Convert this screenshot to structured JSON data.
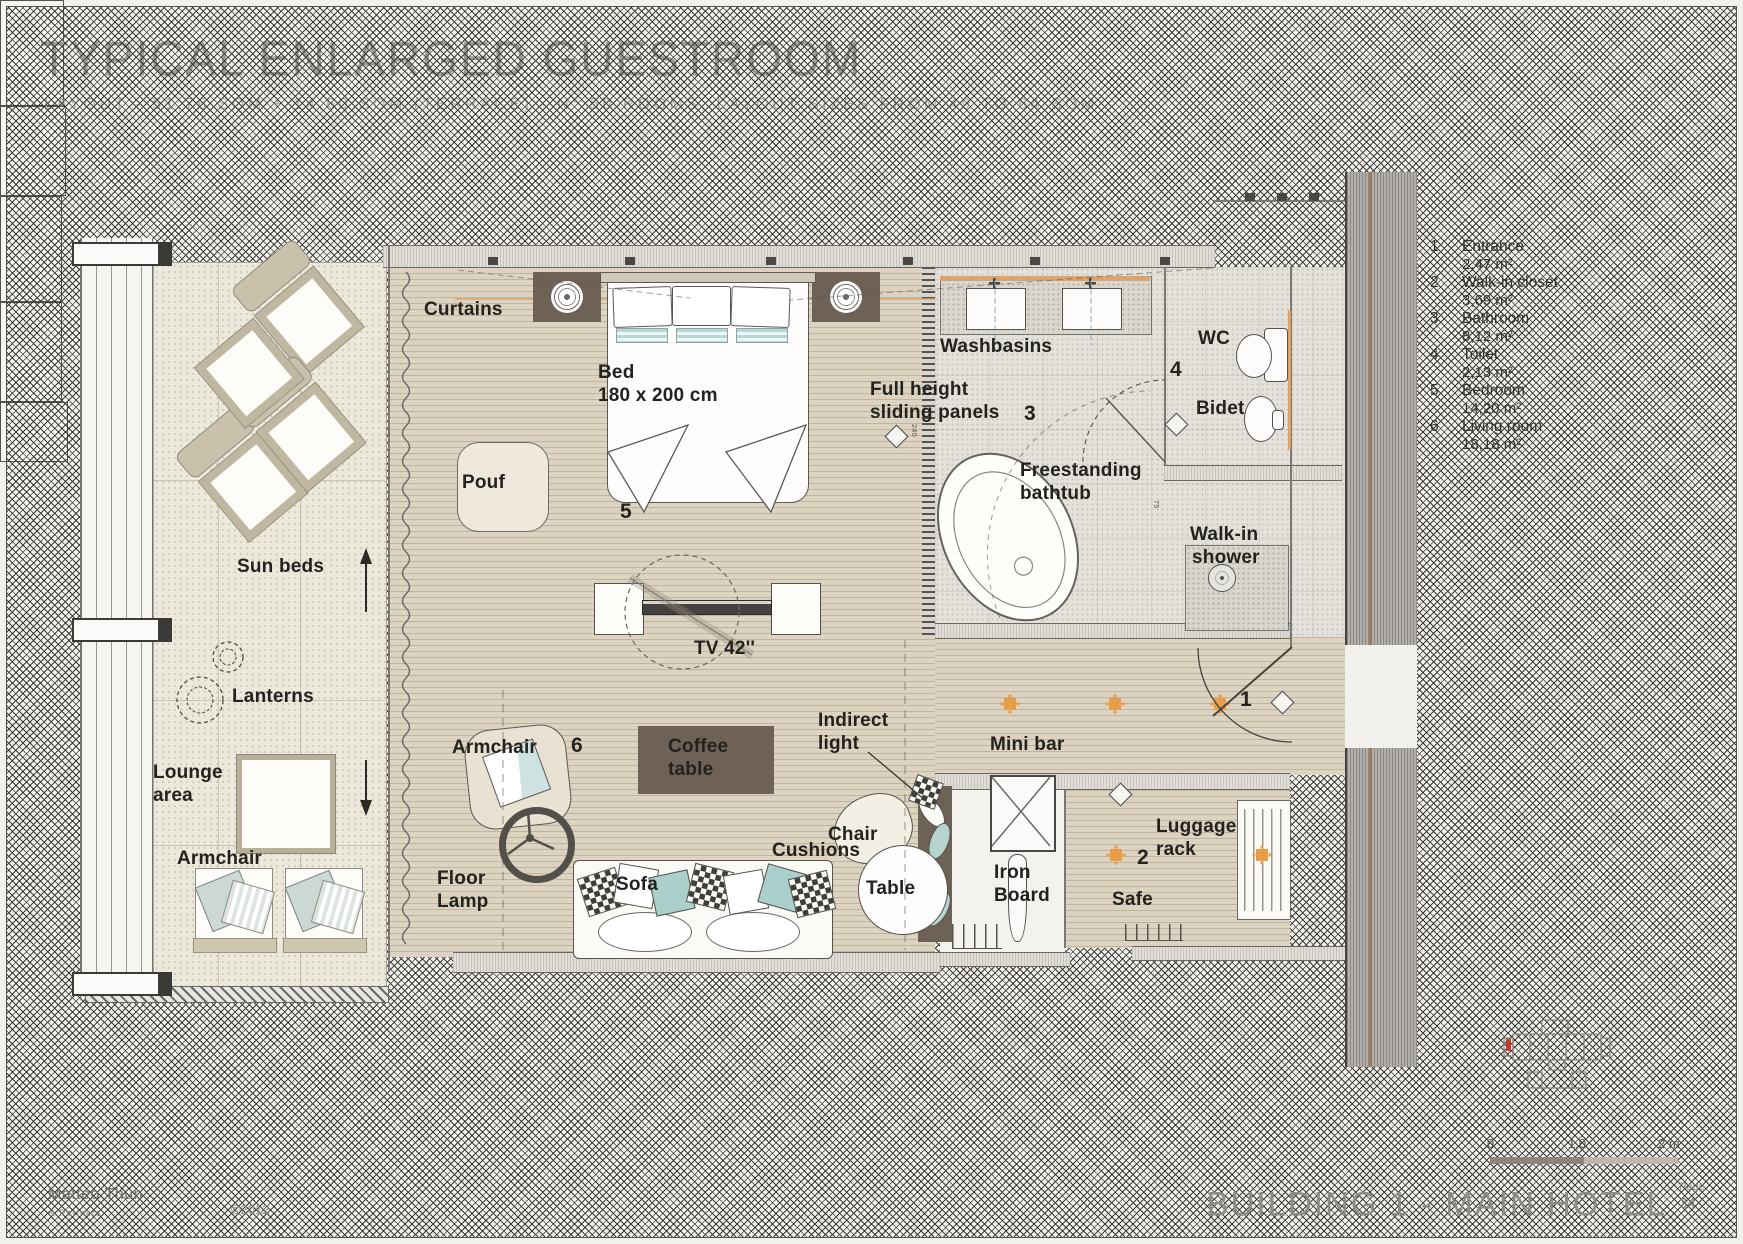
{
  "header": {
    "title": "TYPICAL ENLARGED GUESTROOM",
    "subtitle": "LAYOUT - 51,76 SQM + 14,60 SQM (TERRACE) - N° 50 ROOMS, LAYOUT SIZES FROM 49 TO 64 SQM"
  },
  "plan": {
    "labels": {
      "curtains": "Curtains",
      "bed_line1": "Bed",
      "bed_line2": "180 x 200 cm",
      "pouf": "Pouf",
      "sun_beds": "Sun beds",
      "lanterns": "Lanterns",
      "lounge_line1": "Lounge",
      "lounge_line2": "area",
      "armchair_terrace": "Armchair",
      "armchair_room": "Armchair",
      "floor_lamp_line1": "Floor",
      "floor_lamp_line2": "Lamp",
      "sofa": "Sofa",
      "coffee_line1": "Coffee",
      "coffee_line2": "table",
      "tv": "TV 42''",
      "indirect_line1": "Indirect",
      "indirect_line2": "light",
      "chair": "Chair",
      "table": "Table",
      "cushions": "Cushions",
      "iron_line1": "Iron",
      "iron_line2": "Board",
      "minibar": "Mini bar",
      "safe": "Safe",
      "luggage_line1": "Luggage",
      "luggage_line2": "rack",
      "washbasins": "Washbasins",
      "sliding_line1": "Full height",
      "sliding_line2": "sliding panels",
      "bathtub_line1": "Freestanding",
      "bathtub_line2": "bathtub",
      "wc": "WC",
      "bidet": "Bidet",
      "shower_line1": "Walk-in",
      "shower_line2": "shower"
    },
    "room_numbers": {
      "n1": "1",
      "n2": "2",
      "n3": "3",
      "n4": "4",
      "n5": "5",
      "n6": "6"
    },
    "dims": {
      "a": "240",
      "b": "75"
    }
  },
  "legend": {
    "items": [
      {
        "num": "1",
        "name": "Entrance",
        "area": "2,47 m²"
      },
      {
        "num": "2",
        "name": "Walk-in closet",
        "area": "3,69 m²"
      },
      {
        "num": "3",
        "name": "Bathroom",
        "area": "8,12 m²"
      },
      {
        "num": "4",
        "name": "Toilet",
        "area": "2,13 m²"
      },
      {
        "num": "5",
        "name": "Bedroom",
        "area": "14,20 m²"
      },
      {
        "num": "6",
        "name": "Living room",
        "area": "18,18 m²"
      }
    ]
  },
  "scalebar": {
    "t0": "0",
    "t1": "1,0",
    "t2": "2 m"
  },
  "footer": {
    "firm_name": "Matteo Thun",
    "firm_sub": "& Partners",
    "copyright": "©2012",
    "sheet_title": "BUILDING 1 - MAIN HOTEL",
    "page_label": "Page",
    "page_number": "34"
  }
}
